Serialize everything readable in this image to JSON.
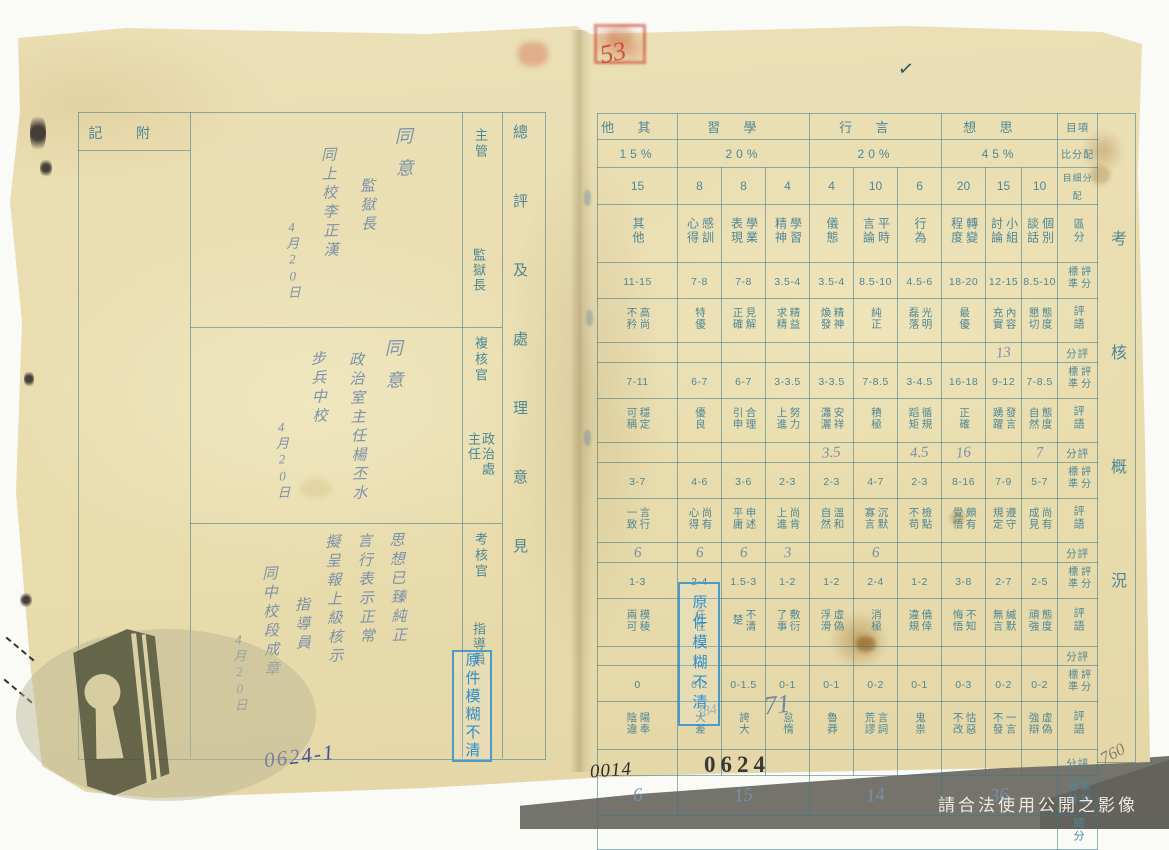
{
  "left_page": {
    "header_note": "附記",
    "overall_header": "總評及處理意見",
    "roles": [
      {
        "type": "主管",
        "title": "監獄長"
      },
      {
        "type": "複核官",
        "title": "政治處主任"
      },
      {
        "type": "考核官",
        "title": "指導員"
      }
    ],
    "sections": [
      {
        "lines": [
          "同意",
          "監獄長",
          "同上校李正漢",
          "4月20日"
        ]
      },
      {
        "lines": [
          "同意",
          "政治室主任楊丕水",
          "步兵中校",
          "4月20日"
        ]
      },
      {
        "lines": [
          "思想已臻純正",
          "言行表示正常",
          "擬呈報上級核示",
          "指導員",
          "同中校段成章",
          "4月20日"
        ]
      }
    ],
    "doc_number": "0624-1"
  },
  "right_page": {
    "side_label": "考核概況",
    "labels": {
      "item": "項目",
      "ratio": "配分比",
      "alloc": "配分細目",
      "division": "區分",
      "standard": "評分標準",
      "remark": "評語",
      "score": "評分",
      "subtotal": "累計得分",
      "total": "總分"
    },
    "categories": [
      {
        "name": "其他",
        "percent": "15%"
      },
      {
        "name": "學習",
        "percent": "20%"
      },
      {
        "name": "言行",
        "percent": "20%"
      },
      {
        "name": "思想",
        "percent": "45%"
      }
    ],
    "columns": [
      {
        "name": "其他",
        "points": "15"
      },
      {
        "name": "感訓心得",
        "points": "8"
      },
      {
        "name": "學業表現",
        "points": "8"
      },
      {
        "name": "學習精神",
        "points": "4"
      },
      {
        "name": "儀態",
        "points": "4"
      },
      {
        "name": "平時言論",
        "points": "10"
      },
      {
        "name": "行為",
        "points": "6"
      },
      {
        "name": "轉變程度",
        "points": "20"
      },
      {
        "name": "小組討論",
        "points": "15"
      },
      {
        "name": "個別談話",
        "points": "10"
      }
    ],
    "bands": [
      {
        "std": [
          "11-15",
          "7-8",
          "7-8",
          "3.5-4",
          "3.5-4",
          "8.5-10",
          "4.5-6",
          "18-20",
          "12-15",
          "8.5-10"
        ],
        "remark": [
          "高尚不矜",
          "特優",
          "見解正確",
          "精益求精",
          "精神煥發",
          "純正",
          "光明磊落",
          "最優",
          "內容充實",
          "態度懇切"
        ],
        "score": [
          "",
          "",
          "",
          "",
          "",
          "",
          "",
          "",
          "13",
          ""
        ]
      },
      {
        "std": [
          "7-11",
          "6-7",
          "6-7",
          "3-3.5",
          "3-3.5",
          "7-8.5",
          "3-4.5",
          "16-18",
          "9-12",
          "7-8.5"
        ],
        "remark": [
          "穩定可稱",
          "優良",
          "合理引申",
          "努力上進",
          "安祥瀟灑",
          "積極",
          "循規蹈矩",
          "正確",
          "發言踴躍",
          "態度自然"
        ],
        "score": [
          "",
          "",
          "",
          "",
          "3.5",
          "",
          "4.5",
          "16",
          "",
          "7"
        ]
      },
      {
        "std": [
          "3-7",
          "4-6",
          "3-6",
          "2-3",
          "2-3",
          "4-7",
          "2-3",
          "8-16",
          "7-9",
          "5-7"
        ],
        "remark": [
          "言行一致",
          "尚有心得",
          "申述平庸",
          "尚肯上進",
          "溫和自然",
          "沉默寡言",
          "檢點不苟",
          "頗有覺悟",
          "遵守規定",
          "尚有成見"
        ],
        "score": [
          "6",
          "6",
          "6",
          "3",
          "",
          "6",
          "",
          "",
          "",
          ""
        ]
      },
      {
        "std": [
          "1-3",
          "2-4",
          "1.5-3",
          "1-2",
          "1-2",
          "2-4",
          "1-2",
          "3-8",
          "2-7",
          "2-5"
        ],
        "remark": [
          "模稜兩可",
          "任性",
          "不清楚",
          "敷衍了事",
          "虛偽浮滑",
          "消極",
          "僥倖違規",
          "不知悔悟",
          "緘默無言",
          "態度頑強"
        ],
        "score": [
          "",
          "",
          "",
          "",
          "",
          "",
          "",
          "",
          "",
          ""
        ]
      },
      {
        "std": [
          "0",
          "0-2",
          "0-1.5",
          "0-1",
          "0-1",
          "0-2",
          "0-1",
          "0-3",
          "0-2",
          "0-2"
        ],
        "remark": [
          "陽奉陰違",
          "大差",
          "誇大",
          "怠惰",
          "魯莽",
          "言詞荒謬",
          "鬼祟",
          "怙惡不改",
          "一言不發",
          "虛偽強辯"
        ],
        "score": [
          "",
          "",
          "",
          "",
          "",
          "",
          "",
          "",
          "",
          ""
        ]
      }
    ],
    "subtotals": [
      "6",
      "15",
      "14",
      "36"
    ],
    "total": "71",
    "total_note": "384",
    "stamp_number": "0624",
    "sheet_number": "0014",
    "corner_number": "760"
  },
  "marks": {
    "blur_stamp": "原件模糊不清",
    "red_number": "53",
    "checkmark": "✓"
  },
  "footer": {
    "notice": "請合法使用公開之影像"
  }
}
